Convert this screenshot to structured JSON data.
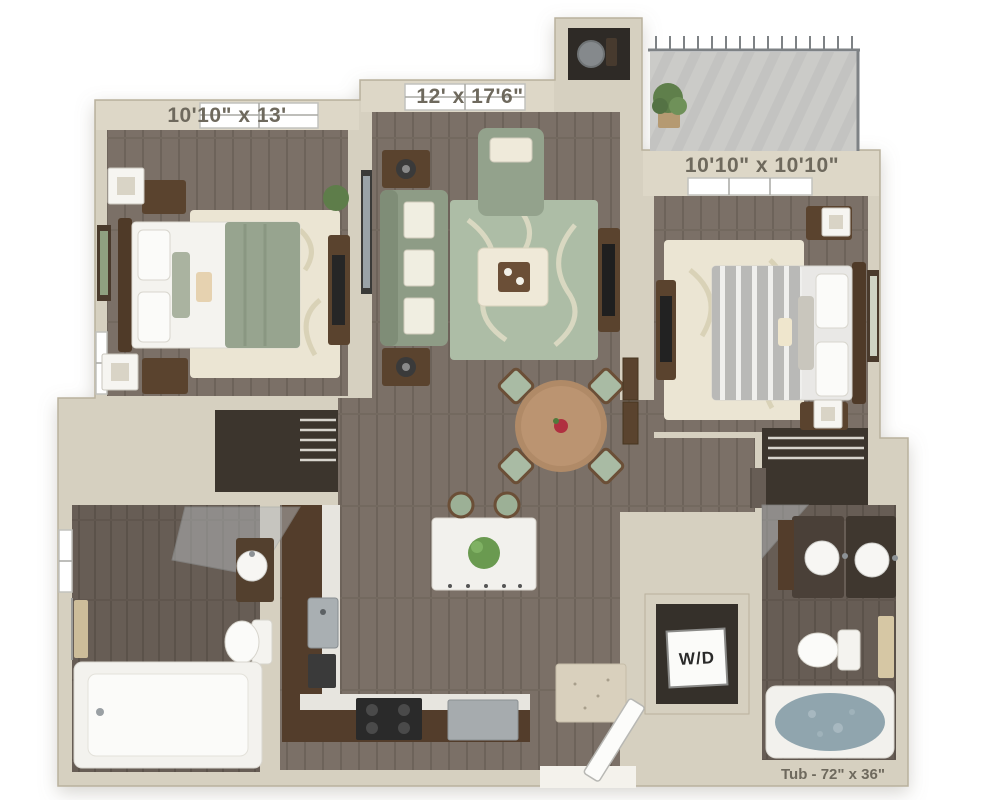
{
  "type": "3d-floor-plan",
  "labels": {
    "bedroom_left_dimensions": "10'10\" x 13'",
    "living_room_dimensions": "12' x 17'6\"",
    "bedroom_right_dimensions": "10'10\" x 10'10\"",
    "washer_dryer": "W/D",
    "tub_note": "Tub - 72\" x 36\""
  },
  "colors": {
    "background": "#ffffff",
    "walls": "#d6d0c0",
    "wall_band": "#ddd7c7",
    "wall_edge": "#b9b19d",
    "floor_wood": "#7b7067",
    "floor_wood_dark": "#6a6058",
    "closet_dark": "#3c352d",
    "rug_cream": "#ebe5d3",
    "rug_sage": "#adbda6",
    "upholstery_sage": "#8e9c86",
    "wood_furniture": "#5a432e",
    "kitchen_cabinet": "#533d2b",
    "countertop": "#e7e5df",
    "fixture_white": "#f4f3ef",
    "tub_water": "#90a5ae",
    "balcony_floor": "#cbcbc8",
    "railing": "#7e8285",
    "label_text": "#6e695d"
  }
}
